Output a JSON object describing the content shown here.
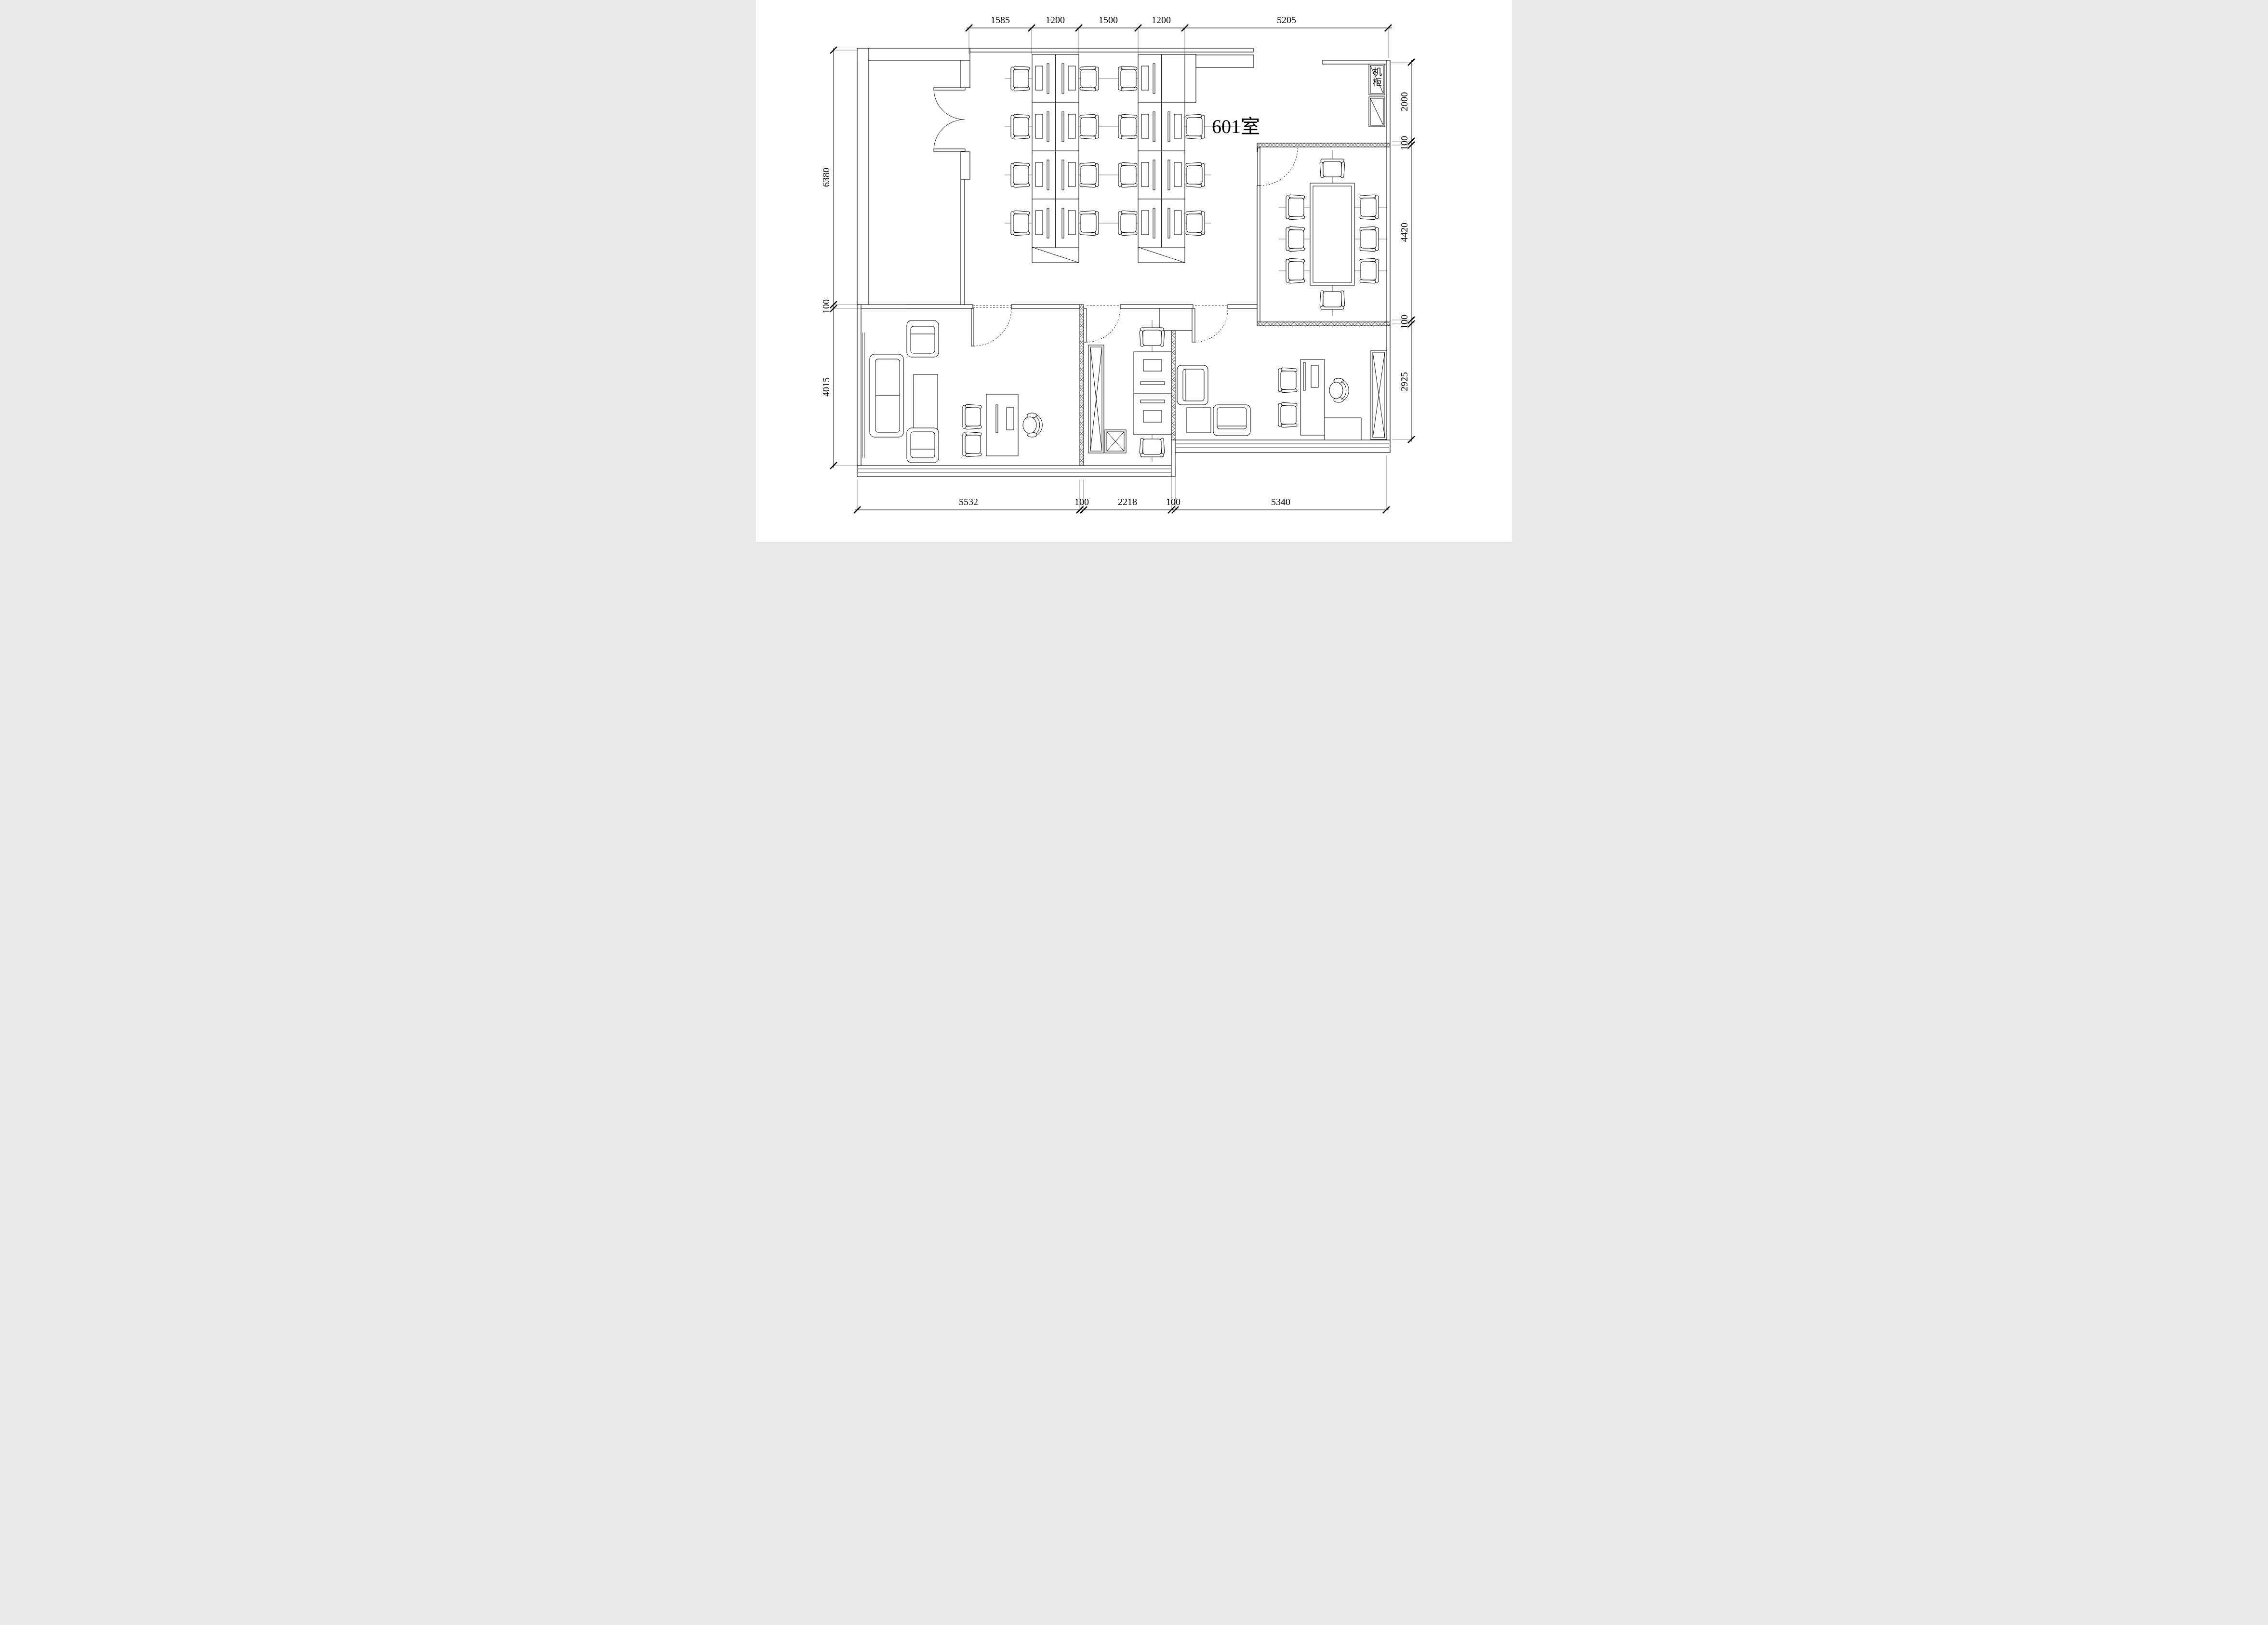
{
  "drawing": {
    "room_label": "601室",
    "cabinet_label": "机柜",
    "colors": {
      "line": "#000000",
      "background": "#ffffff"
    },
    "dimensions": {
      "top": [
        "1585",
        "1200",
        "1500",
        "1200",
        "5205"
      ],
      "left": [
        "6380",
        "100",
        "4015"
      ],
      "right": [
        "2000",
        "100",
        "4420",
        "100",
        "2925"
      ],
      "bottom": [
        "5532",
        "100",
        "2218",
        "100",
        "5340"
      ]
    }
  }
}
